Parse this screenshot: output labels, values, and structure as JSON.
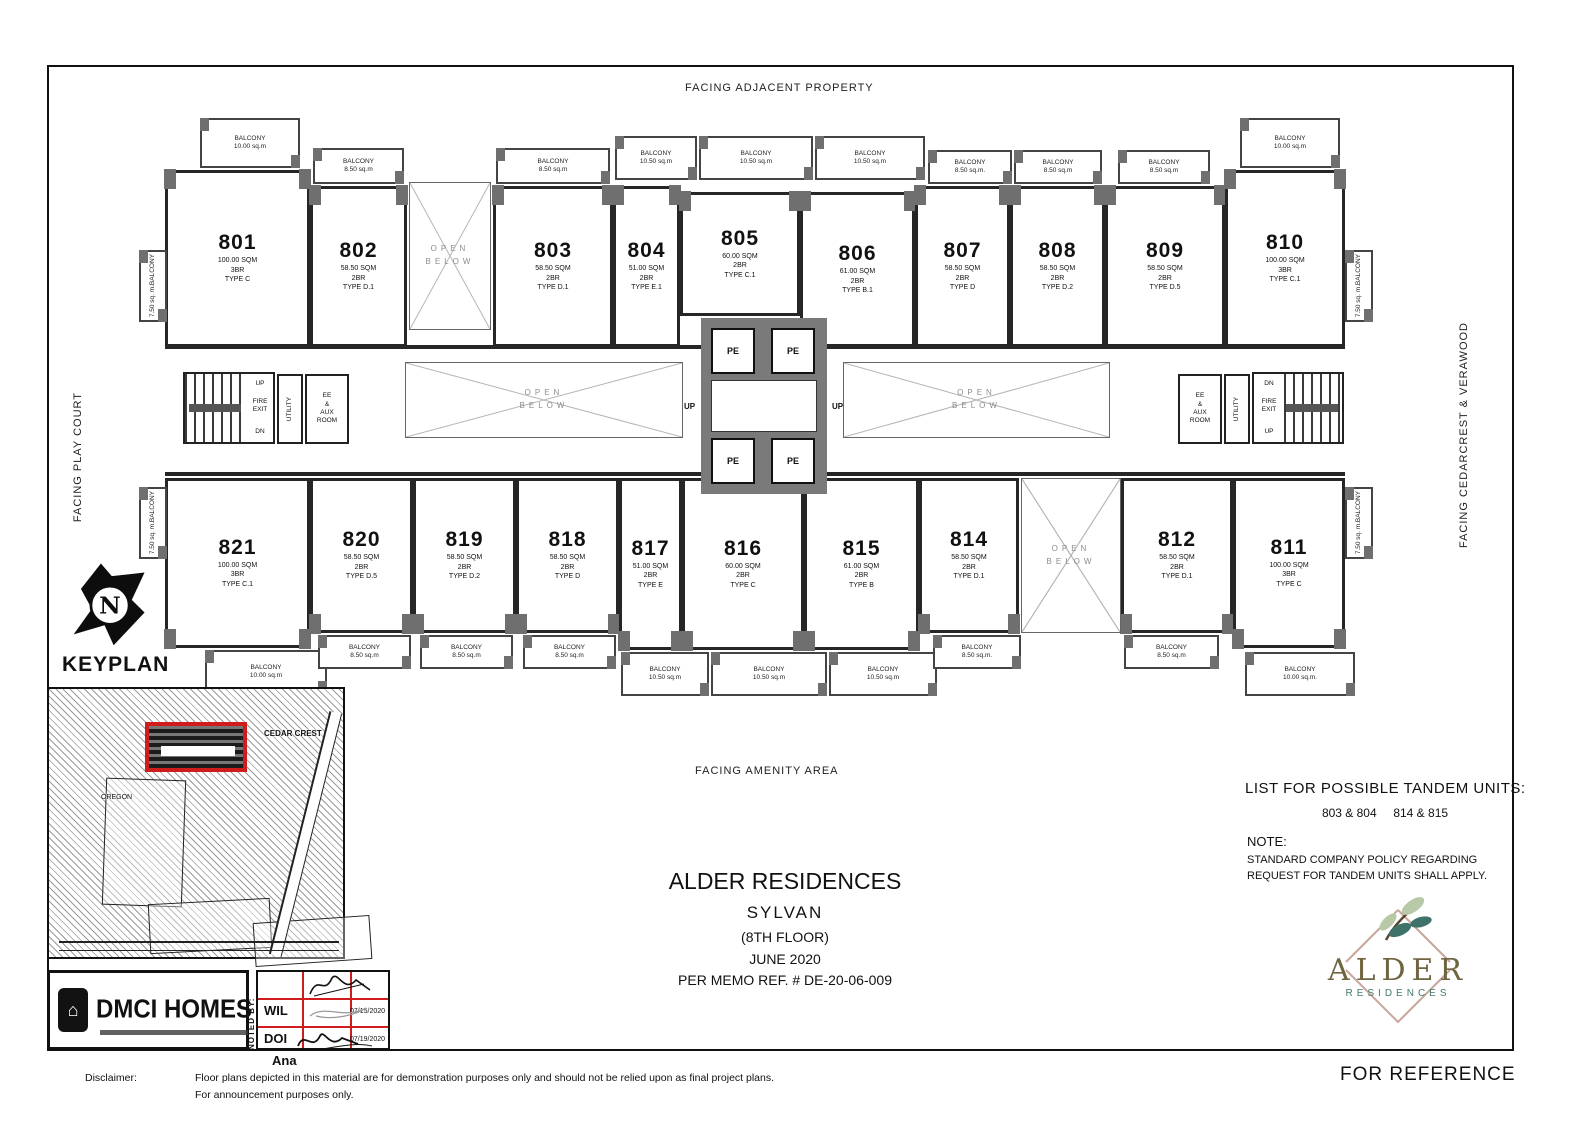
{
  "facing": {
    "top": "FACING ADJACENT PROPERTY",
    "left": "FACING PLAY COURT",
    "right": "FACING CEDARCREST & VERAWOOD",
    "bottom": "FACING AMENITY AREA"
  },
  "labels": {
    "balcony": "BALCONY",
    "open": "OPEN",
    "below": "BELOW",
    "pe": "PE",
    "up": "UP",
    "dn": "DN",
    "fire1": "FIRE",
    "fire2": "EXIT",
    "utility": "UTILITY",
    "ee1": "EE",
    "ee2": "&",
    "ee3": "AUX",
    "ee4": "ROOM"
  },
  "units": [
    {
      "number": "801",
      "area": "100.00 SQM",
      "br": "3BR",
      "type": "TYPE C"
    },
    {
      "number": "802",
      "area": "58.50 SQM",
      "br": "2BR",
      "type": "TYPE D.1"
    },
    {
      "number": "803",
      "area": "58.50 SQM",
      "br": "2BR",
      "type": "TYPE D.1"
    },
    {
      "number": "804",
      "area": "51.00 SQM",
      "br": "2BR",
      "type": "TYPE E.1"
    },
    {
      "number": "805",
      "area": "60.00 SQM",
      "br": "2BR",
      "type": "TYPE C.1"
    },
    {
      "number": "806",
      "area": "61.00 SQM",
      "br": "2BR",
      "type": "TYPE B.1"
    },
    {
      "number": "807",
      "area": "58.50 SQM",
      "br": "2BR",
      "type": "TYPE D"
    },
    {
      "number": "808",
      "area": "58.50 SQM",
      "br": "2BR",
      "type": "TYPE D.2"
    },
    {
      "number": "809",
      "area": "58.50 SQM",
      "br": "2BR",
      "type": "TYPE D.5"
    },
    {
      "number": "810",
      "area": "100.00 SQM",
      "br": "3BR",
      "type": "TYPE C.1"
    },
    {
      "number": "811",
      "area": "100.00 SQM",
      "br": "3BR",
      "type": "TYPE C"
    },
    {
      "number": "812",
      "area": "58.50 SQM",
      "br": "2BR",
      "type": "TYPE D.1"
    },
    {
      "number": "814",
      "area": "58.50 SQM",
      "br": "2BR",
      "type": "TYPE D.1"
    },
    {
      "number": "815",
      "area": "61.00 SQM",
      "br": "2BR",
      "type": "TYPE B"
    },
    {
      "number": "816",
      "area": "60.00 SQM",
      "br": "2BR",
      "type": "TYPE C"
    },
    {
      "number": "817",
      "area": "51.00 SQM",
      "br": "2BR",
      "type": "TYPE E"
    },
    {
      "number": "818",
      "area": "58.50 SQM",
      "br": "2BR",
      "type": "TYPE D"
    },
    {
      "number": "819",
      "area": "58.50 SQM",
      "br": "2BR",
      "type": "TYPE D.2"
    },
    {
      "number": "820",
      "area": "58.50 SQM",
      "br": "2BR",
      "type": "TYPE D.5"
    },
    {
      "number": "821",
      "area": "100.00 SQM",
      "br": "3BR",
      "type": "TYPE C.1"
    }
  ],
  "balconies": [
    "10.00 sq.m",
    "8.50 sq.m",
    "8.50 sq.m",
    "10.50 sq.m",
    "10.50 sq.m",
    "10.50 sq.m",
    "8.50 sq.m.",
    "8.50 sq.m",
    "8.50 sq.m",
    "10.00 sq.m",
    "7.50 sq. m.",
    "7.50 sq. m.",
    "7.50 sq. m.",
    "7.50 sq. m.",
    "10.00 sq.m",
    "8.50 sq.m",
    "8.50 sq.m",
    "8.50 sq.m",
    "10.50 sq.m",
    "10.50 sq.m",
    "10.50 sq.m",
    "8.50 sq.m.",
    "8.50 sq.m",
    "10.00 sq.m."
  ],
  "keyplan": {
    "label": "KEYPLAN",
    "north": "N",
    "cedar_crest": "CEDAR CREST",
    "oregon": "OREGON"
  },
  "title_block": {
    "project": "ALDER RESIDENCES",
    "building": "SYLVAN",
    "floor": "(8TH FLOOR)",
    "date": "JUNE 2020",
    "memo": "PER MEMO REF. # DE-20-06-009"
  },
  "tandem": {
    "heading": "LIST FOR POSSIBLE TANDEM UNITS:",
    "pairs": [
      "803 & 804",
      "814 & 815"
    ],
    "note_label": "NOTE:",
    "note_line1": "STANDARD COMPANY POLICY REGARDING",
    "note_line2": "REQUEST FOR TANDEM UNITS SHALL APPLY."
  },
  "branding": {
    "dmci": "DMCI HOMES",
    "house_glyph": "⌂",
    "alder": "ALDER",
    "residences": "RESIDENCES"
  },
  "signoff": {
    "noted_by": "NOTED BY:",
    "rows": [
      {
        "initials": "WIL",
        "date": "07/15/2020"
      },
      {
        "initials": "DOI",
        "date": "07/19/2020"
      }
    ],
    "name": "Ana"
  },
  "disclaimer": {
    "label": "Disclaimer:",
    "line1": "Floor plans depicted in this material are for demonstration purposes only and should not be relied upon as final project plans.",
    "line2": "For announcement purposes only.",
    "for_reference": "FOR REFERENCE"
  }
}
